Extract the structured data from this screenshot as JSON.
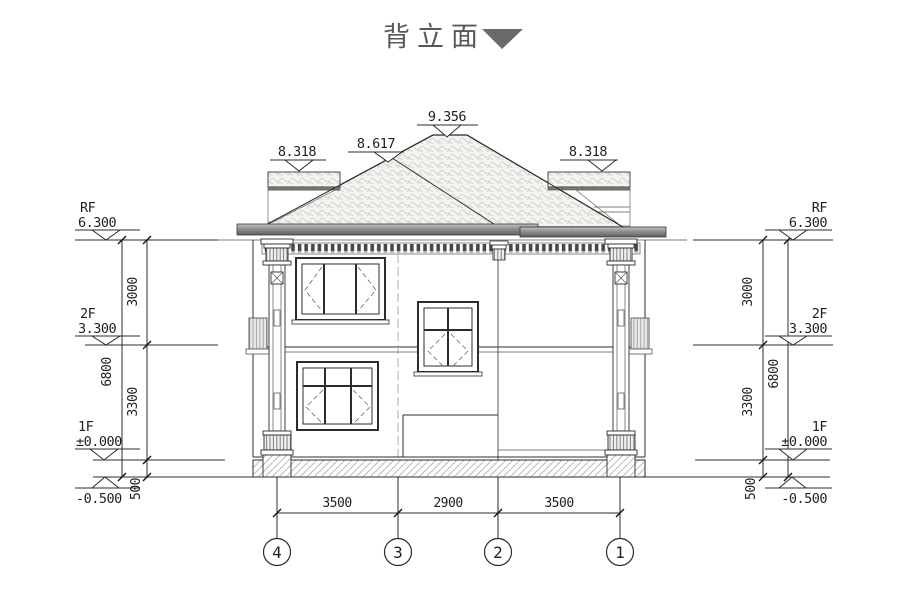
{
  "title": {
    "text": "背立面"
  },
  "roof_markers": {
    "peak": "9.356",
    "mid_left": "8.617",
    "parapet_left": "8.318",
    "parapet_right": "8.318"
  },
  "levels": {
    "rf": {
      "label": "RF",
      "value": "6.300"
    },
    "f2": {
      "label": "2F",
      "value": "3.300"
    },
    "f1": {
      "label": "1F",
      "value": "±0.000"
    },
    "below_grade": {
      "value": "-0.500"
    }
  },
  "vertical_dims": {
    "upper_floor_height": "3000",
    "lower_floor_height": "3300",
    "plinth_height": "500",
    "total_height": "6800"
  },
  "horizontal_dims": {
    "left_bay": "3500",
    "middle_bay": "2900",
    "right_bay": "3500"
  },
  "axes": {
    "a4": "4",
    "a3": "3",
    "a2": "2",
    "a1": "1"
  },
  "colors": {
    "line": "#2c2c2c",
    "title_gray": "#585858",
    "eave_band": "#8f8f8f",
    "tile_light": "#f3f3f0"
  }
}
